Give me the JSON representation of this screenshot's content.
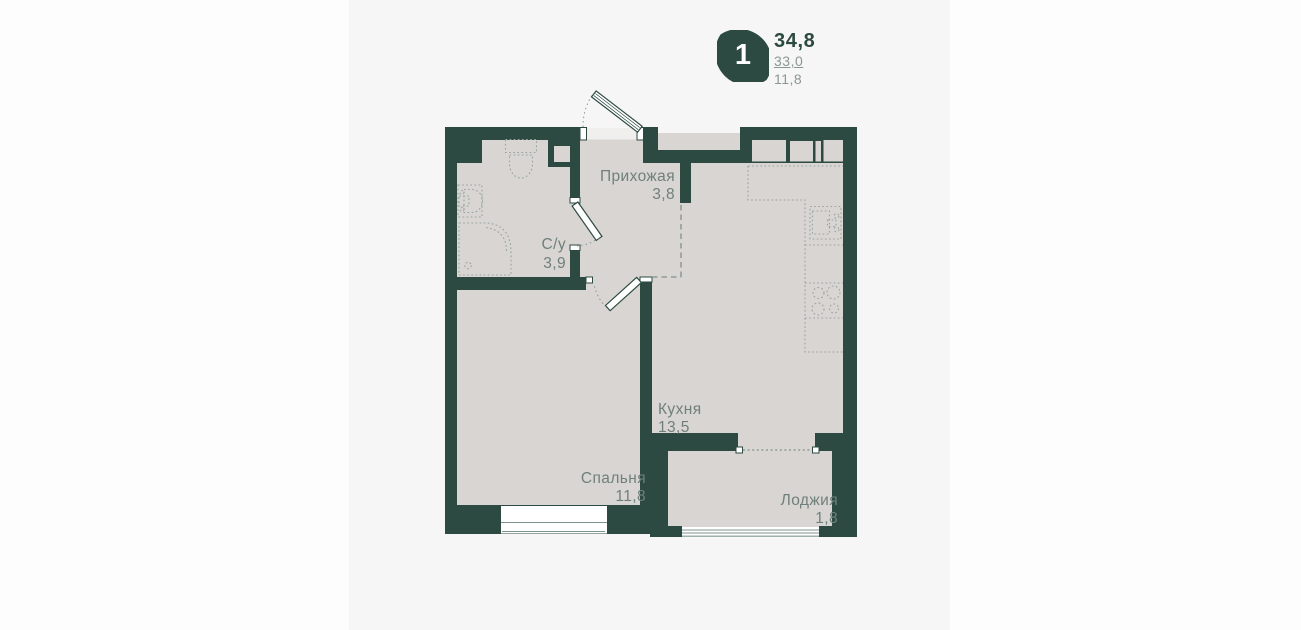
{
  "legend": {
    "rooms_count": "1",
    "total_area": "34,8",
    "living_area": "33,0",
    "extra_area": "11,8"
  },
  "rooms": [
    {
      "name": "Прихожая",
      "area": "3,8"
    },
    {
      "name": "С/у",
      "area": "3,9"
    },
    {
      "name": "Кухня",
      "area": "13,5"
    },
    {
      "name": "Спальня",
      "area": "11,8"
    },
    {
      "name": "Лоджия",
      "area": "1,8"
    }
  ],
  "colors": {
    "background": "#fcfdfc",
    "panel": "#f5f6f5",
    "wall": "#2c4a42",
    "floor": "#d9d5d2",
    "label_text": "#6f807b",
    "fixture_line": "#98a5a0",
    "legend_secondary": "#8a9893"
  }
}
